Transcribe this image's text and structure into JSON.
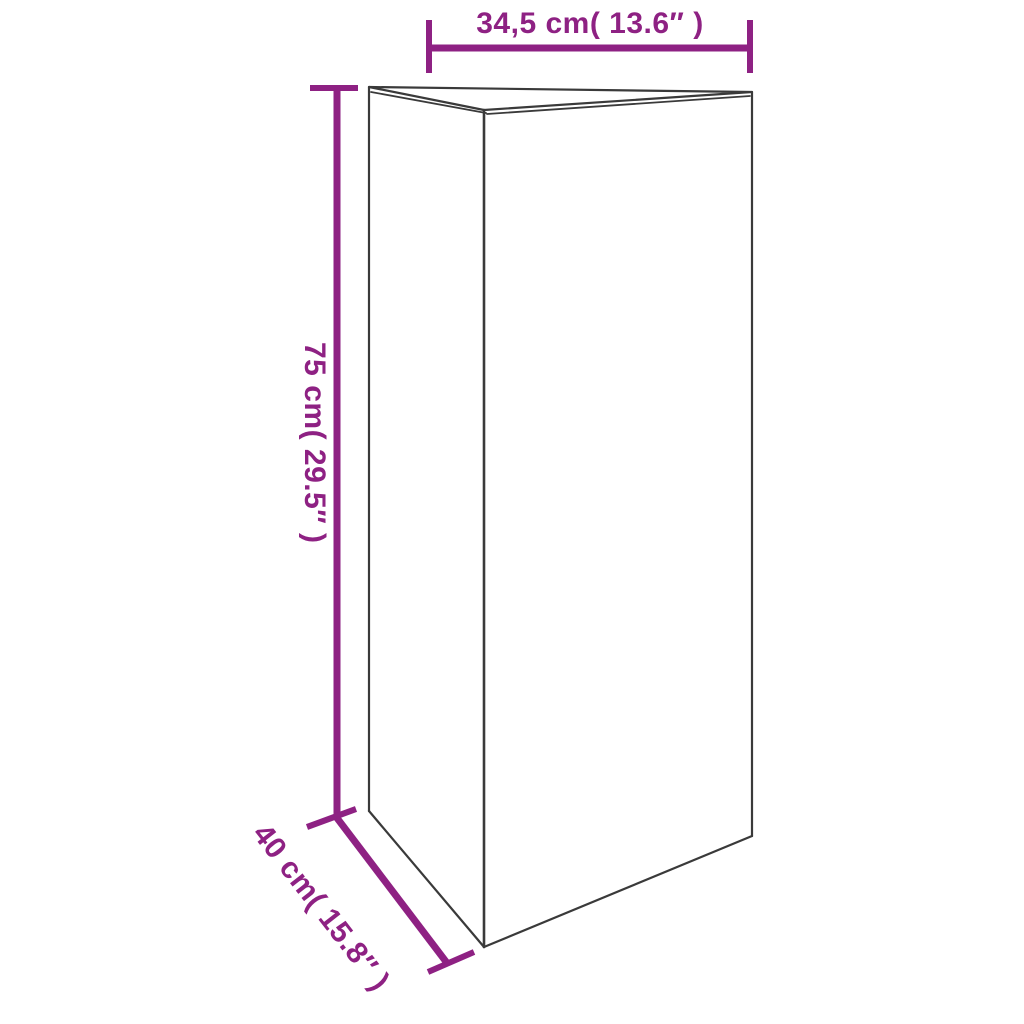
{
  "diagram": {
    "kind": "product-dimension-diagram",
    "object": "triangular-prism-planter",
    "background_color": "#ffffff",
    "outline_color": "#3a3a3a",
    "dimension_color": "#8e2183",
    "labels": {
      "width": "34,5 cm( 13.6″ )",
      "height": "75 cm( 29.5″ )",
      "depth": "40 cm( 15.8″ )"
    },
    "values": {
      "width_cm": "34,5",
      "width_inch": "13.6",
      "height_cm": "75",
      "height_inch": "29.5",
      "depth_cm": "40",
      "depth_inch": "15.8"
    }
  }
}
